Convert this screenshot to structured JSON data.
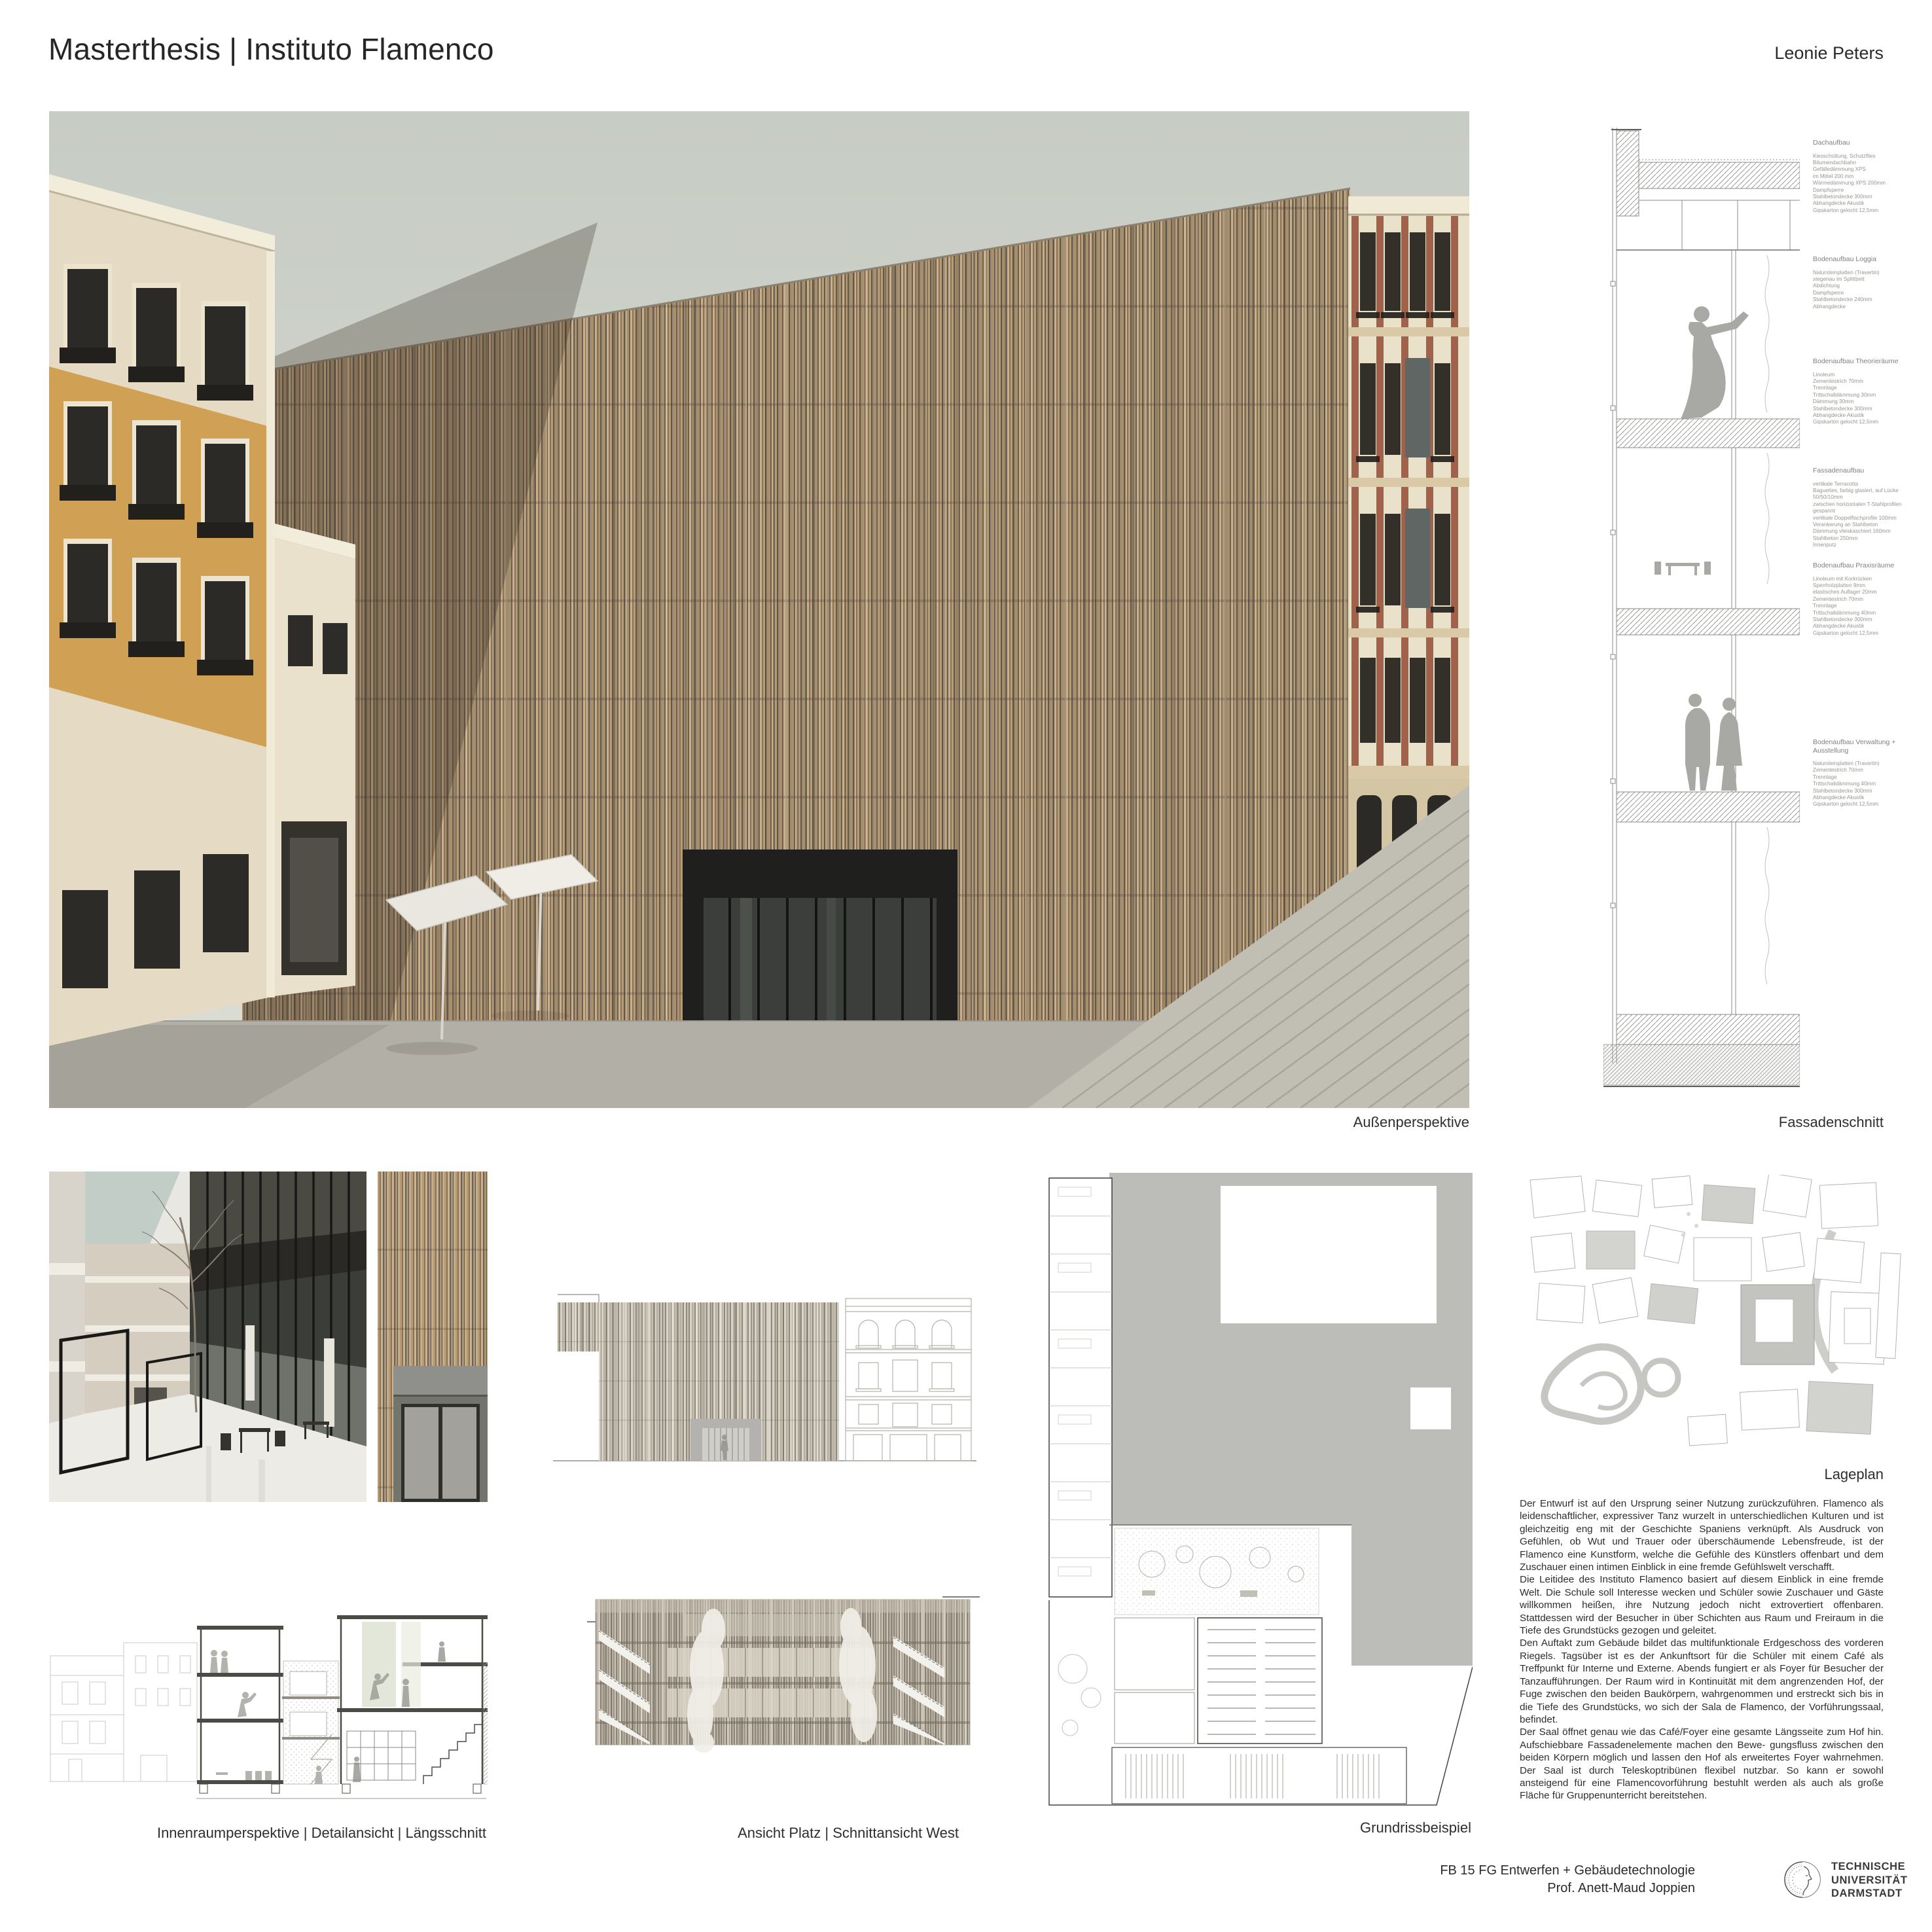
{
  "header": {
    "title": "Masterthesis | Instituto Flamenco",
    "author": "Leonie Peters"
  },
  "captions": {
    "main": "Außenperspektive",
    "facade_section": "Fassadenschnitt",
    "bottom_left": "Innenraumperspektive | Detailansicht | Längsschnitt",
    "bottom_middle": "Ansicht Platz | Schnittansicht West",
    "plan": "Grundrissbeispiel",
    "site": "Lageplan"
  },
  "facade_annotations": [
    {
      "heading": "Dachaufbau",
      "lines": [
        "Kiesschüttung, Schutzflies",
        "Bitumendachbahn",
        "Gefälledämmung XPS",
        "im Mittel 200 mm",
        "Wärmedämmung XPS 200mm",
        "Dampfsperre",
        "Stahlbetondecke 300mm",
        "Abhangdecke Akustik",
        "Gipskarton gelocht 12,5mm"
      ]
    },
    {
      "heading": "Bodenaufbau Loggia",
      "lines": [
        "Natursteinplatten (Travertin)",
        "stegenau im Splittbett",
        "Abdichtung",
        "Dampfsperre",
        "Stahlbetondecke 240mm",
        "Abhangdecke"
      ]
    },
    {
      "heading": "Bodenaufbau Theorieräume",
      "lines": [
        "Linoleum",
        "Zementestrich 70mm",
        "Trennlage",
        "Trittschalldämmung 30mm",
        "Dämmung 30mm",
        "Stahlbetondecke 300mm",
        "Abhangdecke Akustik",
        "Gipskarton gelocht 12,5mm"
      ]
    },
    {
      "heading": "Fassadenaufbau",
      "lines": [
        "vertikale Terracotta",
        "Baguettes, farbig glasiert, auf Lücke",
        "50/50/10mm",
        "zwischen horizontalen T-Stahlprofilen",
        "gespannt",
        "vertikale Doppelflachprofile 100mm",
        "Verankerung an Stahlbeton",
        "Dämmung vlieskaschiert 160mm",
        "Stahlbeton 250mm",
        "Innenputz"
      ]
    },
    {
      "heading": "Bodenaufbau Praxisräume",
      "lines": [
        "Linoleum mit Korkrücken",
        "Sperrholzplatten 9mm",
        "elastisches Auflager 20mm",
        "Zementestrich 70mm",
        "Trennlage",
        "Trittschalldämmung 40mm",
        "Stahlbetondecke 300mm",
        "Abhangdecke Akustik",
        "Gipskarton gelocht 12,5mm"
      ]
    },
    {
      "heading": "Bodenaufbau Verwaltung + Ausstellung",
      "lines": [
        "Natursteinplatten (Travertin)",
        "Zementestrich 70mm",
        "Trennlage",
        "Trittschalldämmung 40mm",
        "Stahlbetondecke 300mm",
        "Abhangdecke Akustik",
        "Gipskarton gelocht 12,5mm"
      ]
    }
  ],
  "body_text": {
    "paragraphs": [
      "Der Entwurf ist auf den Ursprung seiner Nutzung zurückzuführen. Flamenco als leidenschaftlicher, expressiver Tanz wurzelt in unterschiedlichen Kulturen und ist gleichzeitig eng mit der Geschichte Spaniens verknüpft. Als Ausdruck von Gefühlen, ob Wut und Trauer oder überschäumende Lebensfreude, ist der Flamenco eine Kunstform, welche die Gefühle des Künstlers offenbart und dem Zuschauer einen intimen Einblick in eine fremde Gefühlswelt verschafft.",
      "Die Leitidee des Instituto Flamenco basiert auf diesem Einblick in eine fremde Welt. Die Schule soll Interesse wecken und Schüler sowie Zuschauer und Gäste willkommen heißen, ihre Nutzung jedoch nicht extrovertiert offenbaren. Stattdessen wird der Besucher in über Schichten aus Raum und Freiraum in die Tiefe des Grundstücks gezogen und geleitet.",
      "Den Auftakt zum Gebäude bildet das multifunktionale Erdgeschoss des vorderen Riegels. Tagsüber ist es der Ankunftsort für die Schüler mit einem Café als Treffpunkt für Interne und Externe. Abends fungiert er als Foyer für Besucher der Tanzaufführungen. Der Raum wird in Kontinuität mit dem angrenzenden Hof, der Fuge zwischen den beiden Baukörpern, wahrgenommen und erstreckt sich bis in die Tiefe des Grundstücks, wo sich der Sala de Flamenco, der Vorführungssaal, befindet.",
      "Der Saal öffnet genau wie das Café/Foyer eine gesamte Längsseite zum Hof hin. Aufschiebbare Fassadenelemente machen den Bewe- gungsfluss zwischen den beiden Körpern möglich und lassen den Hof als erweitertes Foyer wahrnehmen. Der Saal ist durch Teleskoptribünen flexibel nutzbar. So kann er sowohl ansteigend für eine Flamencovorführung bestuhlt werden als auch als große Fläche für Gruppenunterricht bereitstehen."
    ]
  },
  "footer": {
    "credit_line1": "FB 15 FG Entwerfen + Gebäudetechnologie",
    "credit_line2": "Prof. Anett-Maud Joppien",
    "logo_lines": [
      "TECHNISCHE",
      "UNIVERSITÄT",
      "DARMSTADT"
    ]
  },
  "colors": {
    "terracotta": "#a8906e",
    "paper": "#ffffff",
    "text": "#2f2e2b",
    "annotation_grey": "#96968f",
    "plaza_grey": "#b2afa6",
    "ochre_building": "#d0a155"
  }
}
